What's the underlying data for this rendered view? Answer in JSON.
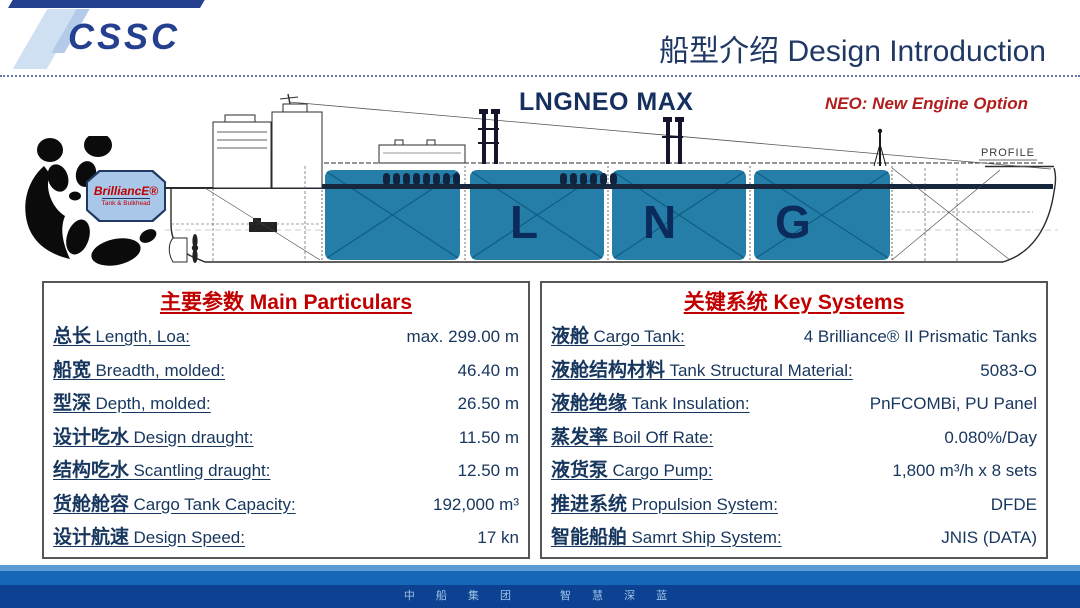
{
  "header": {
    "logo_text": "CSSC",
    "title": "船型介绍 Design Introduction"
  },
  "ship": {
    "name": "LNGNEO MAX",
    "note": "NEO: New Engine Option",
    "profile_label": "PROFILE",
    "tank_letters": [
      "L",
      "N",
      "G"
    ],
    "badge": {
      "main": "BrilliancE®",
      "sub": "Tank & Bulkhead"
    }
  },
  "main_particulars": {
    "title": "主要参数 Main Particulars",
    "rows": [
      {
        "cn": "总长",
        "en": "Length, Loa:",
        "value": "max. 299.00 m"
      },
      {
        "cn": "船宽",
        "en": "Breadth, molded:",
        "value": "46.40 m"
      },
      {
        "cn": "型深",
        "en": "Depth, molded:",
        "value": "26.50 m"
      },
      {
        "cn": "设计吃水",
        "en": "Design draught:",
        "value": "11.50 m"
      },
      {
        "cn": "结构吃水",
        "en": "Scantling draught:",
        "value": "12.50 m"
      },
      {
        "cn": "货舱舱容",
        "en": "Cargo Tank Capacity:",
        "value": "192,000 m³"
      },
      {
        "cn": "设计航速",
        "en": "Design Speed:",
        "value": "17 kn"
      }
    ]
  },
  "key_systems": {
    "title": "关键系统 Key Systems",
    "rows": [
      {
        "cn": "液舱",
        "en": "Cargo Tank:",
        "value": "4 Brilliance® II Prismatic Tanks"
      },
      {
        "cn": "液舱结构材料",
        "en": "Tank Structural Material:",
        "value": "5083-O"
      },
      {
        "cn": "液舱绝缘",
        "en": "Tank Insulation:",
        "value": "PnFCOMBi, PU Panel"
      },
      {
        "cn": "蒸发率",
        "en": "Boil Off Rate:",
        "value": "0.080%/Day"
      },
      {
        "cn": "液货泵",
        "en": "Cargo Pump:",
        "value": "1,800 m³/h x 8 sets"
      },
      {
        "cn": "推进系统",
        "en": "Propulsion System:",
        "value": "DFDE"
      },
      {
        "cn": "智能船舶",
        "en": "Samrt Ship System:",
        "value": "JNIS (DATA)"
      }
    ]
  },
  "footer": {
    "slogan": "中 船 集 团　　智 慧 深 蓝"
  },
  "colors": {
    "navy_text": "#17365D",
    "title_navy": "#1F3864",
    "logo_navy": "#24408E",
    "red_accent": "#C00000",
    "note_red": "#B01E1E",
    "tank_teal": "#247EA8",
    "footer_light": "#5B9BD5",
    "footer_mid": "#1767B8",
    "footer_dark": "#0D4191"
  }
}
